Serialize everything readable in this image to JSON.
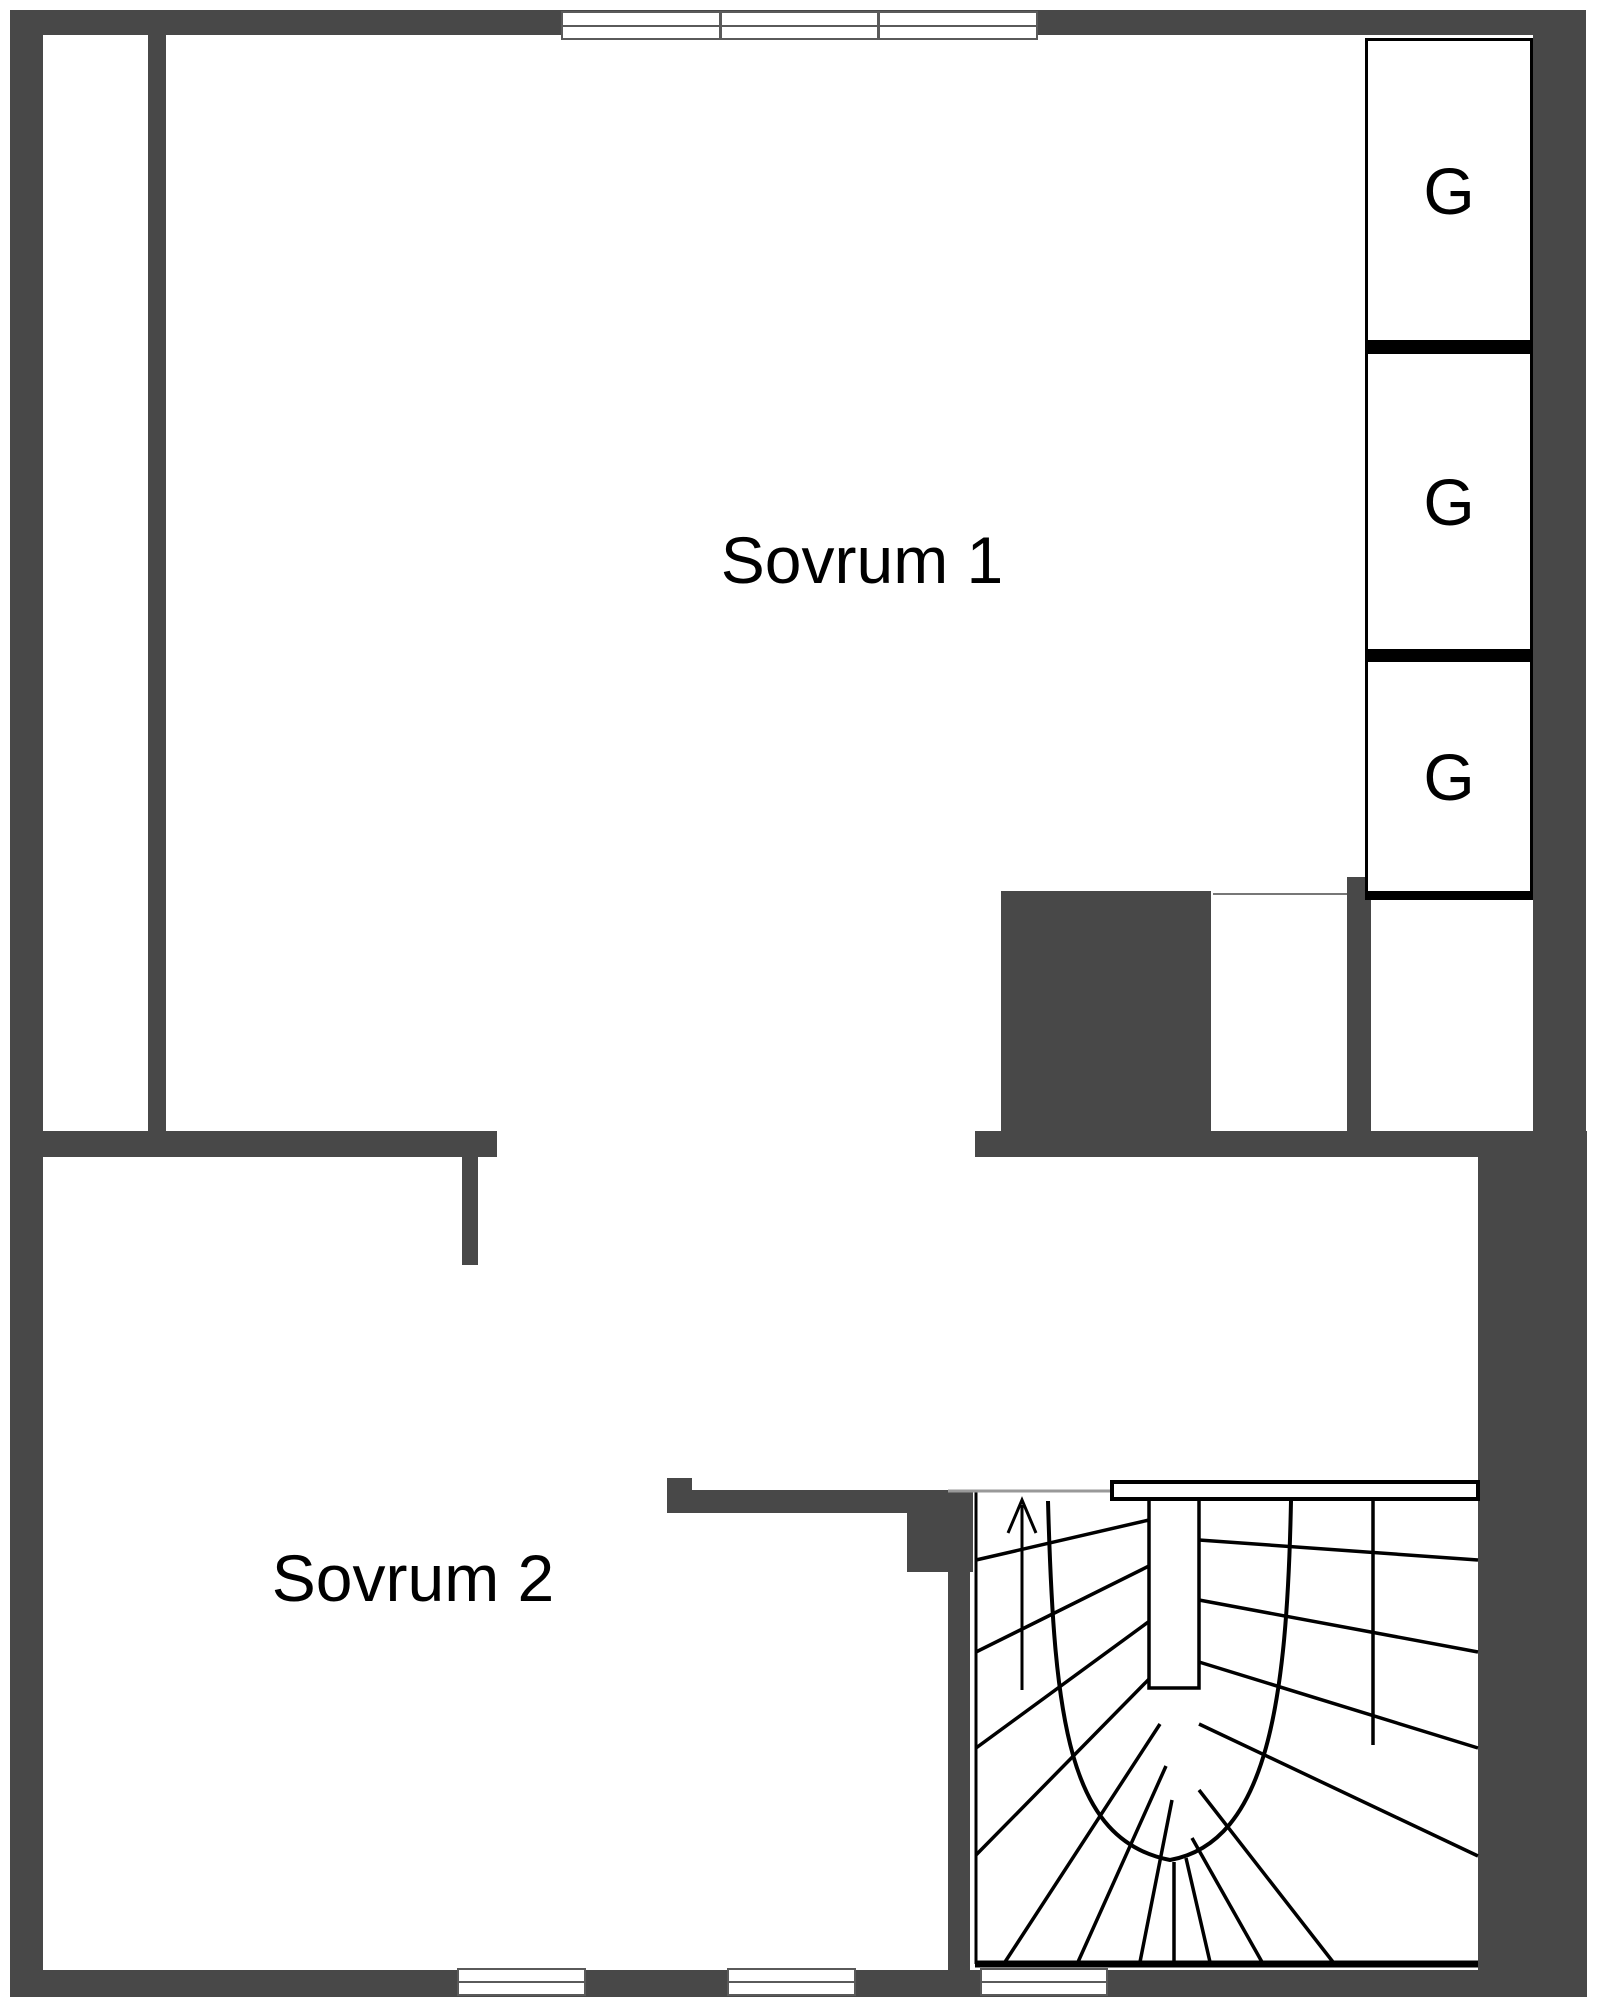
{
  "rooms": [
    {
      "name": "Sovrum 1"
    },
    {
      "name": "Sovrum 2"
    }
  ],
  "closets": [
    {
      "label": "G"
    },
    {
      "label": "G"
    },
    {
      "label": "G"
    }
  ],
  "stairs": {
    "arrow_direction": "up"
  },
  "colors": {
    "wall": "#484848",
    "line": "#000000",
    "window_frame": "#5a5a5a",
    "background": "#ffffff"
  }
}
